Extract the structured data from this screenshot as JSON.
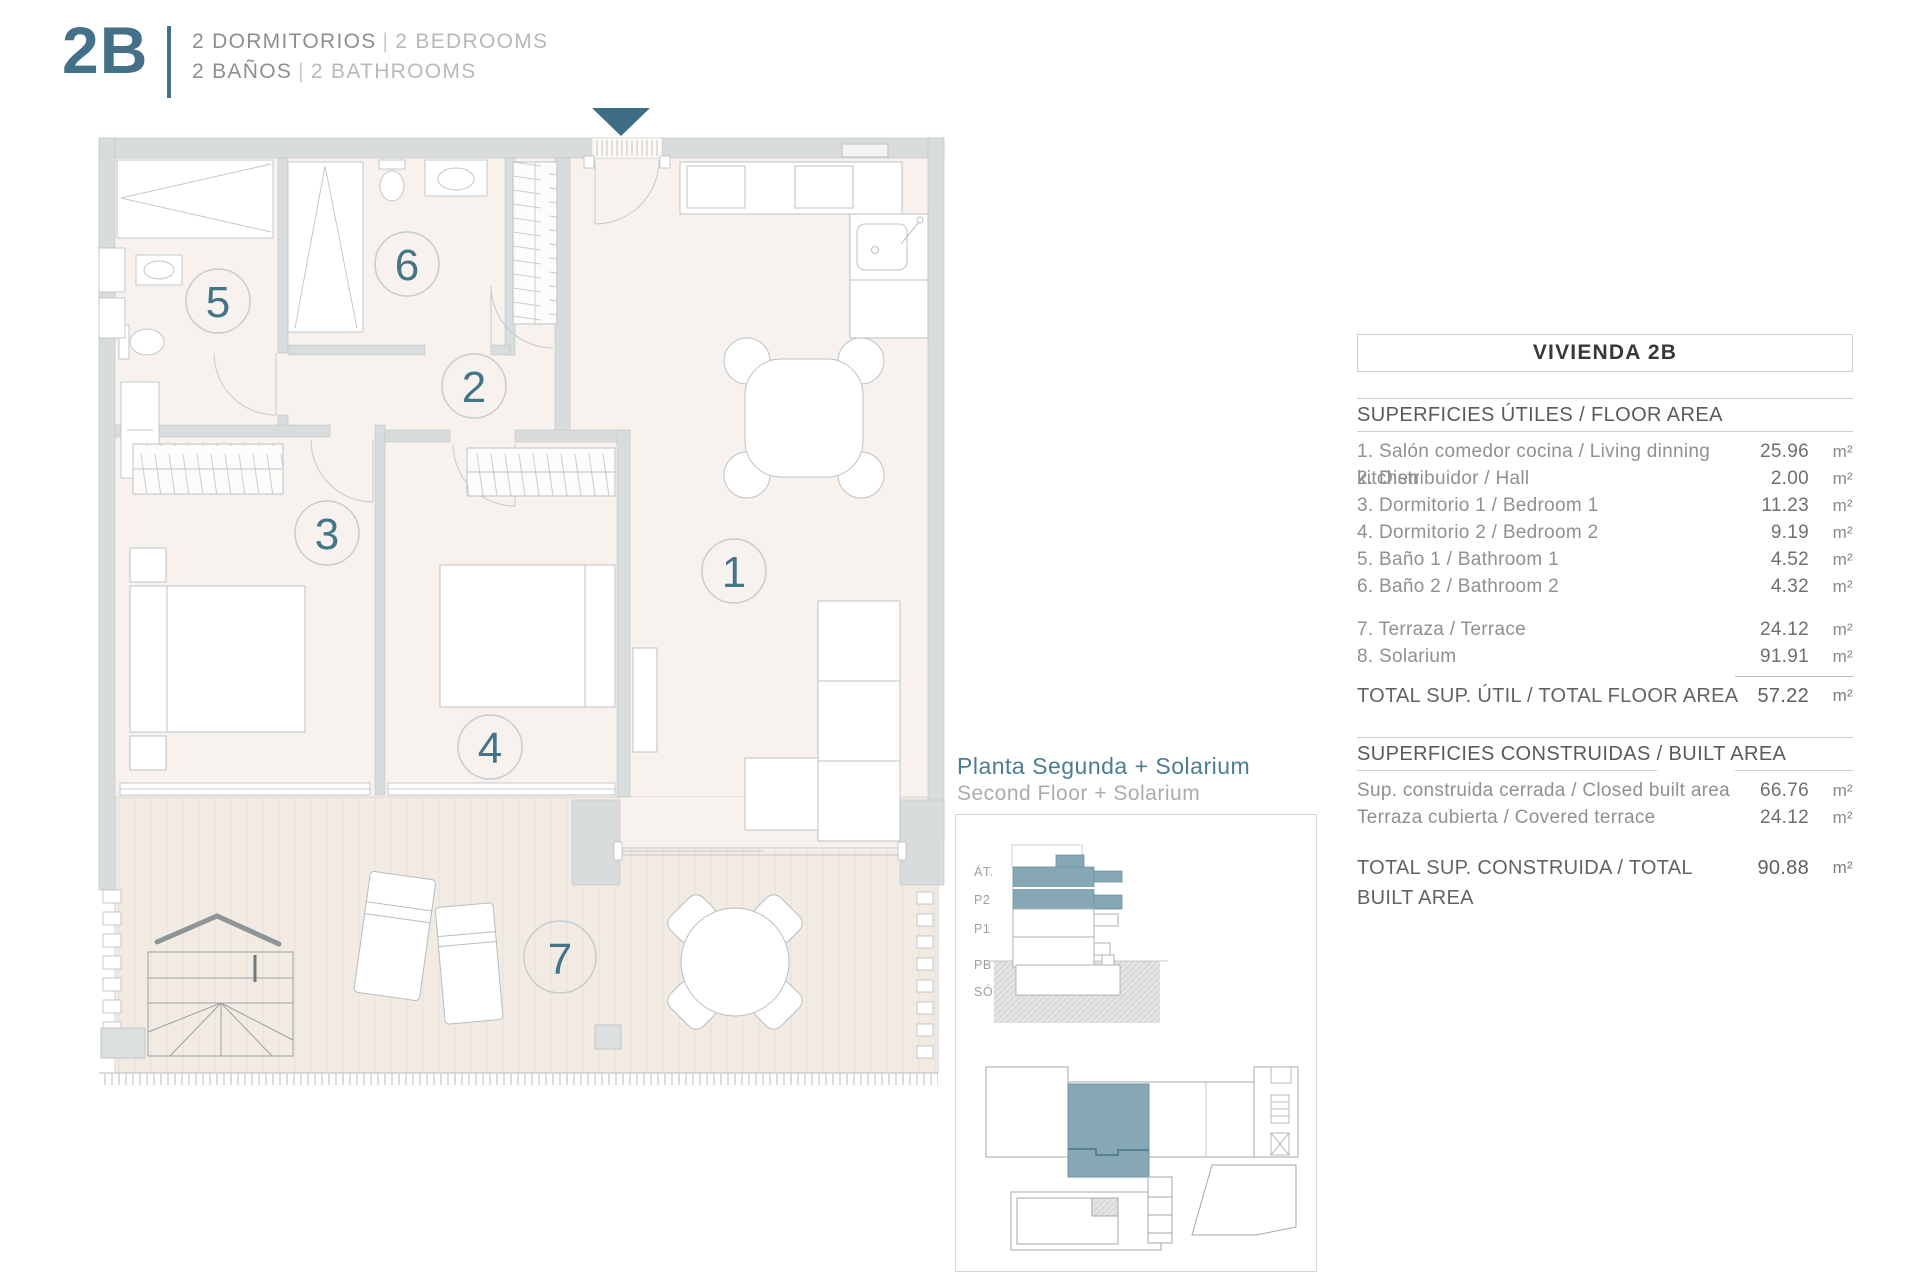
{
  "header": {
    "unit_code": "2B",
    "separator": "|",
    "bedrooms_es": "2 DORMITORIOS",
    "bedrooms_en": "2 BEDROOMS",
    "bathrooms_es": "2 BAÑOS",
    "bathrooms_en": "2 BATHROOMS"
  },
  "plan": {
    "rooms": [
      "1",
      "2",
      "3",
      "4",
      "5",
      "6",
      "7"
    ]
  },
  "locator": {
    "title_es": "Planta Segunda + Solarium",
    "title_en": "Second Floor + Solarium",
    "levels": [
      "ÁT.",
      "P2",
      "P1",
      "PB",
      "SÓT."
    ]
  },
  "table": {
    "title": "VIVIENDA 2B",
    "unit": "m²",
    "floor_area": {
      "header": "SUPERFICIES ÚTILES / FLOOR AREA",
      "rows": [
        {
          "label": "1. Salón comedor cocina / Living dinning kitchen",
          "value": "25.96"
        },
        {
          "label": "2. Distribuidor / Hall",
          "value": "2.00"
        },
        {
          "label": "3. Dormitorio 1 / Bedroom 1",
          "value": "11.23"
        },
        {
          "label": "4. Dormitorio 2 / Bedroom 2",
          "value": "9.19"
        },
        {
          "label": "5. Baño 1 / Bathroom 1",
          "value": "4.52"
        },
        {
          "label": "6. Baño 2 / Bathroom 2",
          "value": "4.32"
        }
      ],
      "terrace_rows": [
        {
          "label": "7. Terraza / Terrace",
          "value": "24.12"
        },
        {
          "label": "8. Solarium",
          "value": "91.91"
        }
      ],
      "total_label": "TOTAL SUP. ÚTIL / TOTAL FLOOR AREA",
      "total_value": "57.22"
    },
    "built_area": {
      "header": "SUPERFICIES CONSTRUIDAS / BUILT AREA",
      "rows": [
        {
          "label": "Sup. construida cerrada / Closed built area",
          "value": "66.76"
        },
        {
          "label": "Terraza cubierta / Covered terrace",
          "value": "24.12"
        }
      ],
      "total_label": "TOTAL SUP. CONSTRUIDA /  TOTAL BUILT AREA",
      "total_value": "90.88"
    }
  },
  "colors": {
    "accent": "#45708a",
    "arrow": "#3e6e85",
    "unit_highlight": "#86a8b5",
    "wall": "#d9dcdd",
    "floor": "#f8f2ee",
    "terrace": "#f2ebe4"
  }
}
